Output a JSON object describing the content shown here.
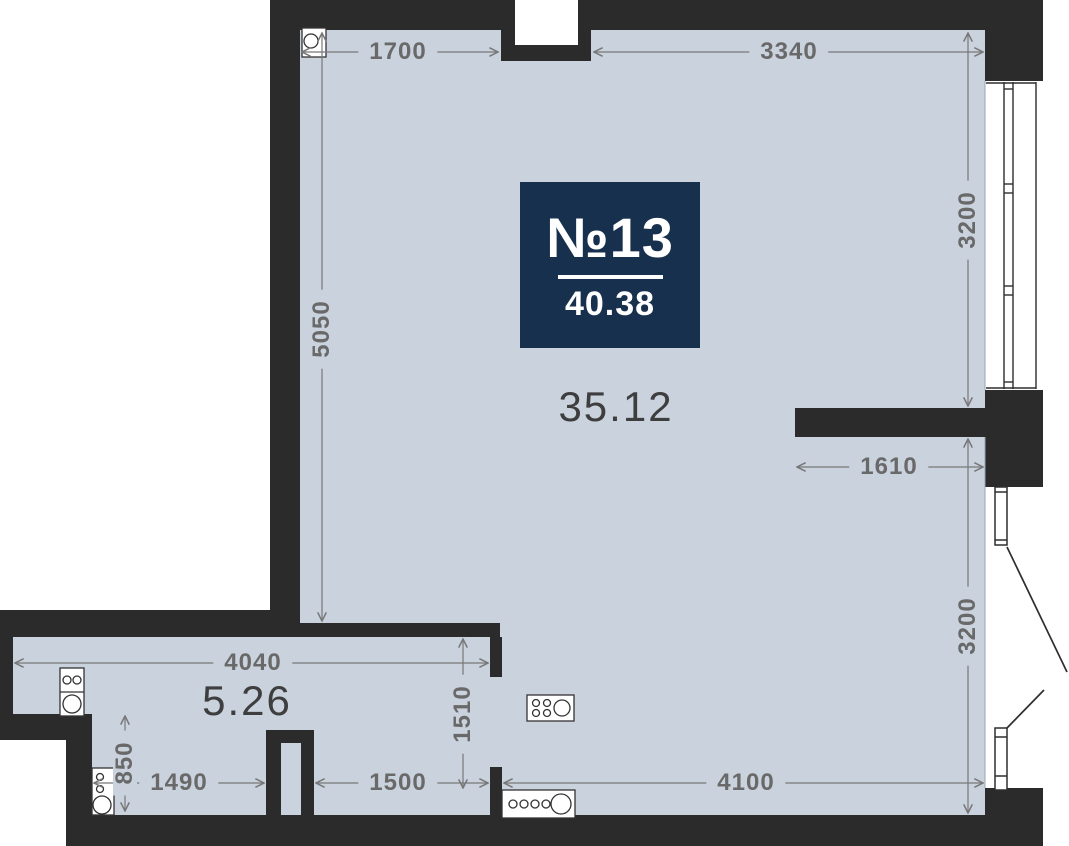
{
  "unit": {
    "badge": {
      "number": "№13",
      "total_area": "40.38"
    },
    "rooms": {
      "main_area": "35.12",
      "kitchen_area": "5.26"
    }
  },
  "dimensions": {
    "d1700": "1700",
    "d3340": "3340",
    "d3200_upper": "3200",
    "d3200_lower": "3200",
    "d5050": "5050",
    "d1610": "1610",
    "d4040": "4040",
    "d1510": "1510",
    "d1490": "1490",
    "d1500": "1500",
    "d4100": "4100",
    "d850": "850"
  },
  "icons": {
    "riser": "circle-in-square plumbing riser",
    "stove": "cooktop with four burners and pot",
    "counter_sink": "counter with four burners row and sink bowl",
    "kitchen_unit_upper": "two-burner unit with sink bowl",
    "kitchen_unit_lower": "narrow unit with taps and sink bowl",
    "window": "triple-pane window symbol",
    "balcony_door": "door leaf with swing line"
  },
  "colors": {
    "floor": "#c9d2dd",
    "wall": "#2b2b2b",
    "badge_bg": "#17304e",
    "badge_text": "#ffffff",
    "dimension_text": "#696969",
    "dimension_line": "#787878",
    "area_text": "#3e3e3e",
    "fixture_stroke": "#333333",
    "outside": "#ffffff"
  }
}
